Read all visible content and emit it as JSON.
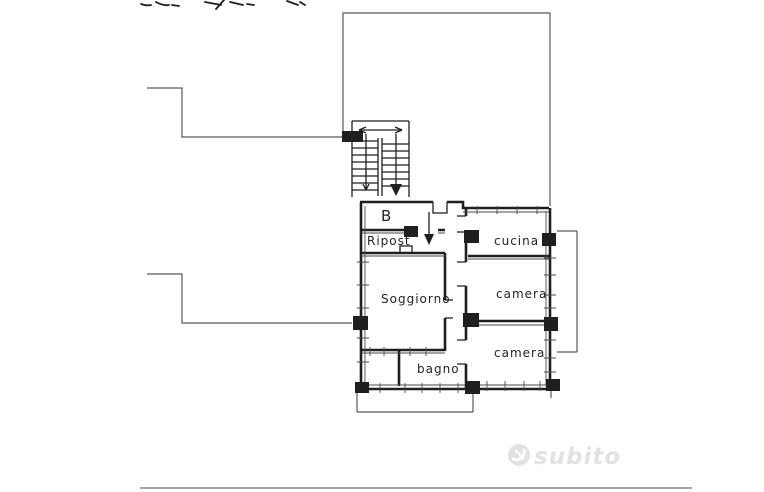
{
  "colors": {
    "background": "#ffffff",
    "ink": "#1f1f1f",
    "line-thin": "#5a5a5a",
    "watermark": "#e2e2e2",
    "divider": "#a6a6a6"
  },
  "floorplan": {
    "type": "apartment-floor-plan",
    "rooms": [
      {
        "name": "entrance-landing",
        "label": "B"
      },
      {
        "name": "ripostiglio",
        "label": "Ripost"
      },
      {
        "name": "soggiorno",
        "label": "Soggiorno"
      },
      {
        "name": "cucina",
        "label": "cucina"
      },
      {
        "name": "camera-1",
        "label": "camera"
      },
      {
        "name": "camera-2",
        "label": "camera"
      },
      {
        "name": "bagno",
        "label": "bagno"
      }
    ]
  },
  "watermark": {
    "brand": "subito",
    "logo_icon": "subito-leaf-logo"
  }
}
